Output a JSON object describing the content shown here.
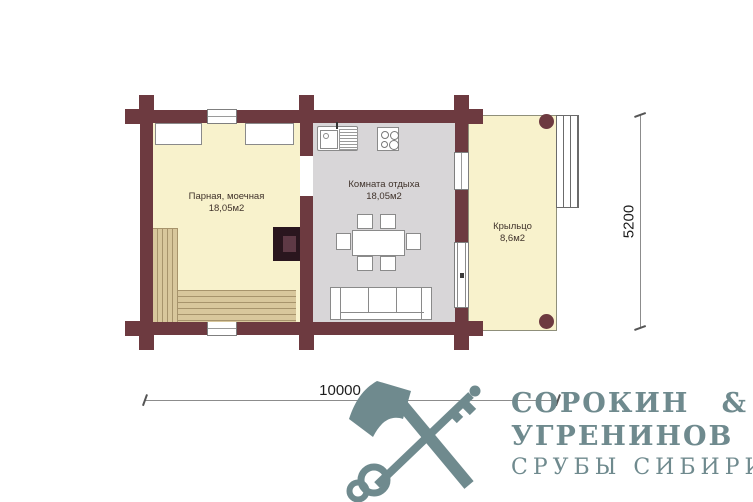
{
  "plan": {
    "rooms": {
      "steam_room": {
        "name": "Парная, моечная",
        "area": "18,05м2"
      },
      "rest_room": {
        "name": "Комната отдыха",
        "area": "18,05м2"
      },
      "porch": {
        "name": "Крыльцо",
        "area": "8,6м2"
      }
    },
    "dimensions": {
      "horizontal": "10000",
      "vertical": "5200"
    }
  },
  "branding": {
    "company_line1": "СОРОКИН",
    "ampersand": "&",
    "company_line2": "УГРЕНИНОВ",
    "tagline": "СРУБЫ СИБИРИ",
    "color": "#6f8a8e"
  },
  "icons": {
    "logo_icon": "axe-and-key"
  },
  "colors": {
    "wall": "#6d3a40",
    "floor_yellow": "#f8f2cc",
    "floor_gray": "#d8d6d8",
    "bench_wood": "#d8c79c",
    "stove_outer": "#2a161e",
    "stove_inner": "#5e3945",
    "furniture_outline": "#8a8a8a"
  }
}
